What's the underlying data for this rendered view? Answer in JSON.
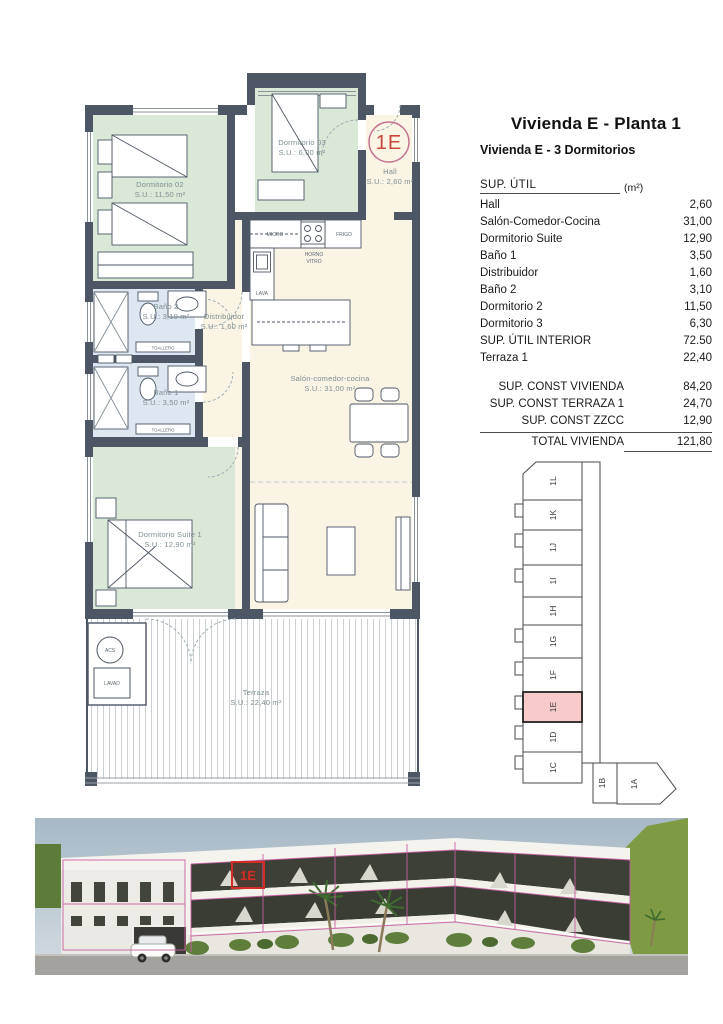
{
  "info_panel": {
    "title": "Vivienda E - Planta 1",
    "subtitle": "Vivienda E - 3 Dormitorios",
    "table": {
      "header_label": "SUP. ÚTIL",
      "header_unit": "(m²)",
      "rows": [
        {
          "label": "Hall",
          "value": "2,60"
        },
        {
          "label": "Salón-Comedor-Cocina",
          "value": "31,00"
        },
        {
          "label": "Dormitorio Suite",
          "value": "12,90"
        },
        {
          "label": "Baño 1",
          "value": "3,50"
        },
        {
          "label": "Distribuidor",
          "value": "1,60"
        },
        {
          "label": "Baño 2",
          "value": "3,10"
        },
        {
          "label": "Dormitorio 2",
          "value": "11,50"
        },
        {
          "label": "Dormitorio 3",
          "value": "6,30"
        },
        {
          "label": "SUP. ÚTIL INTERIOR",
          "value": "72.50"
        },
        {
          "label": "Terraza 1",
          "value": "22,40"
        }
      ],
      "summary": [
        {
          "label": "SUP. CONST VIVIENDA",
          "value": "84,20"
        },
        {
          "label": "SUP. CONST TERRAZA 1",
          "value": "24,70"
        },
        {
          "label": "SUP. CONST ZZCC",
          "value": "12,90"
        },
        {
          "label": "TOTAL VIVIENDA",
          "value": "121,80"
        }
      ]
    }
  },
  "floorplan": {
    "unit_badge": "1E",
    "rooms": {
      "dorm02": {
        "name": "Dormitorio 02",
        "area": "S.U.: 11,50 m²"
      },
      "dorm03": {
        "name": "Dormitorio 03",
        "area": "S.U.: 6,00 m²"
      },
      "hall": {
        "name": "Hall",
        "area": "S.U.: 2,60 m²"
      },
      "bano2": {
        "name": "Baño 2",
        "area": "S.U.: 3,10 m²"
      },
      "distribuidor": {
        "name": "Distribuidor",
        "area": "S.U.: 1,60 m²"
      },
      "bano1": {
        "name": "Baño 1",
        "area": "S.U.: 3,50 m²"
      },
      "salon": {
        "name": "Salón-comedor-cocina",
        "area": "S.U.: 31,00 m²"
      },
      "suite": {
        "name": "Dormitorio Suite 1",
        "area": "S.U.: 12,90 m²"
      },
      "terraza": {
        "name": "Terraza",
        "area": "S.U.: 22,40 m²"
      }
    },
    "kitchen": {
      "micro": "MICRO",
      "frigo": "FRIGO",
      "horno": "HORNO",
      "vitro": "VITRO",
      "lava": "LAVA"
    },
    "fixtures": {
      "toallero": "TOALLERO",
      "acs": "ACS",
      "lavad": "LAVAD"
    }
  },
  "key_plan": {
    "units": [
      "1L",
      "1K",
      "1J",
      "1I",
      "1H",
      "1G",
      "1F",
      "1E",
      "1D",
      "1C",
      "1B",
      "1A"
    ],
    "highlighted_unit": "1E",
    "highlight_color": "#f8cbca"
  },
  "photo": {
    "unit_label": "1E",
    "grid_color": "#c75fa3",
    "highlight_color": "#d42b22"
  },
  "colors": {
    "wall": "#4d5665",
    "bedroom_green": "#d9e8d7",
    "bath_blue": "#dee6f1",
    "living_cream": "#faf4e5",
    "plan_label": "#7d8e91",
    "badge_red": "#c8473d"
  }
}
